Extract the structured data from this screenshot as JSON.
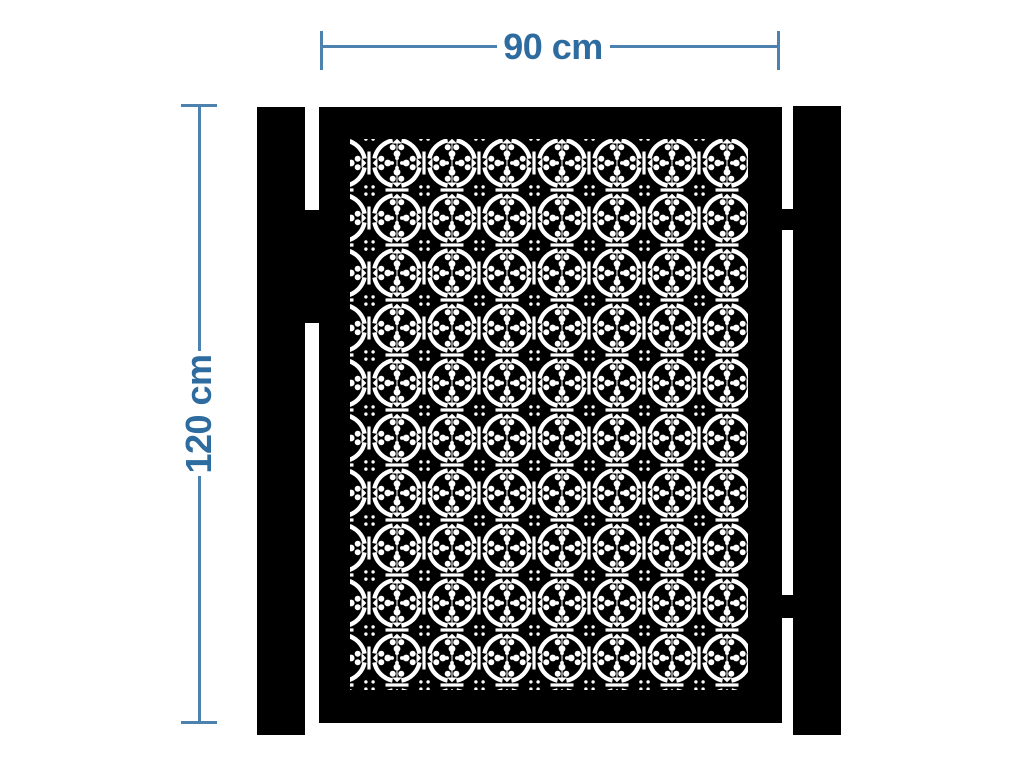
{
  "figure": {
    "subject": "decorative laser-cut garden gate with two mounting posts",
    "view": "front elevation dimension drawing"
  },
  "annotations": {
    "width": {
      "value": 90,
      "unit": "cm",
      "label": "90 cm"
    },
    "height": {
      "value": 120,
      "unit": "cm",
      "label": "120 cm"
    }
  },
  "colors": {
    "annotation_text": "#2e6b9e",
    "annotation_line": "#4e82ae",
    "gate_black": "#000000",
    "background": "#ffffff"
  },
  "icons": {
    "gate_pattern": "ornamental-quatrefoil-lasercut-pattern"
  }
}
